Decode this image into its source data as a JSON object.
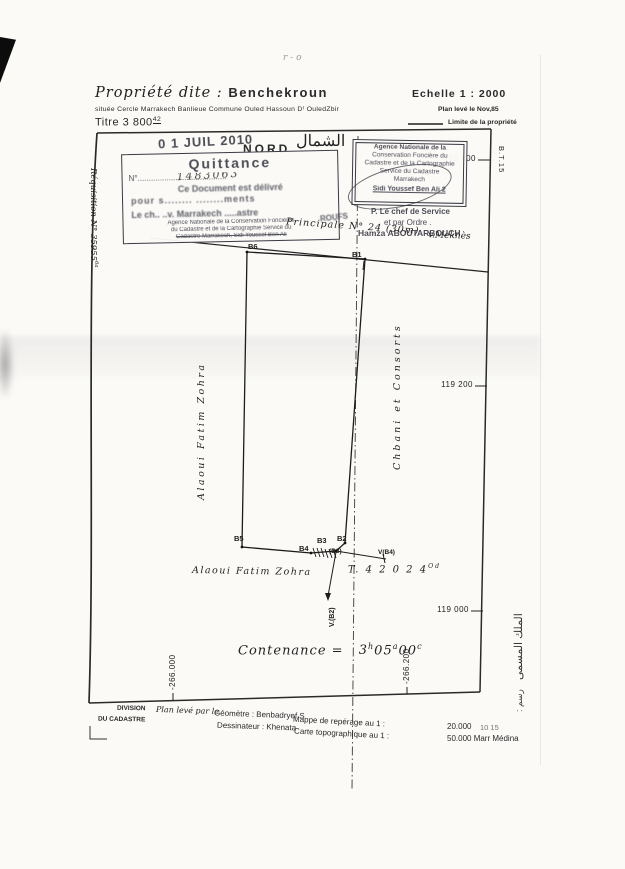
{
  "header": {
    "property_label": "Propriété dite :",
    "property_name": "Benchekroun",
    "scale": "Echelle  1 : 2000",
    "location": "située Cercle Marrakech Banlieue  Commune  Ouled  Hassoun  Dʳ OuledZbir",
    "plan_date": "Plan levé le  Nov,85",
    "title_number": "Titre  3 800",
    "title_sup": "42",
    "legend_limit": "Limite  de  la  propriété",
    "pencil_mark": "r - o"
  },
  "stamps": {
    "date_stamp": "0 1  JUIL  2010",
    "north": "NORD",
    "north_arabic": "الشمال",
    "quittance": {
      "title": "Quittance",
      "no_label": "N°",
      "no_dots": "........................................",
      "no_value": "1483063",
      "line_delivre": "Ce Document est délivré",
      "line_pour": "pour s........  ........ments",
      "line_chef": "Le ch..  ..v. Marrakech  .....astre",
      "agency_1": "Agence Nationale de la Conservation Foncières",
      "agency_2": "du Cadastre et de la Cartographie Service du",
      "agency_3": "Cadastre Marrakech, Sidi Youssef Ben Ali",
      "fragment": "ROUFS"
    },
    "service": {
      "line_1": "Agence Nationale de la",
      "line_2": "Conservation Foncière du",
      "line_3": "Cadastre et de la Cartographie",
      "line_4": "Service du Cadastre",
      "line_5": "Marrakech",
      "line_6": "Sidi Youssef Ben Ali   2"
    },
    "signature": {
      "line_1": "P. Le chef de Service",
      "line_2": "et par Ordre .",
      "line_3": "Hamza ABOUTARBOUCH"
    }
  },
  "plan": {
    "road_label": "Principale  N° 24 (30m)",
    "road_dest": "v.Meknès",
    "requisition": "Réquisition N° 35955",
    "requisition_sup": "6a",
    "owner_left": "Alaoui   Fatim   Zohra",
    "owner_right": "Chbani   et   Consorts",
    "owner_bottom": "Alaoui  Fatim  Zohra",
    "title_ref": "T. 4 2 0 2 4",
    "title_ref_sup": "Od",
    "contenance_label": "Contenance   =",
    "cont_h": "3",
    "cont_h_u": "h",
    "cont_a": "05",
    "cont_a_u": "a",
    "cont_c": "00",
    "cont_c_u": "c",
    "bt_ref": "B.T.15",
    "points": {
      "b6": "B6",
      "b1": "B1",
      "b5": "B5",
      "b4": "B4",
      "b3": "B3",
      "b2": "B2",
      "b3p": "(B3)",
      "vb4": "V(B4)",
      "vb2": "V.(B2)"
    }
  },
  "coords": {
    "right_1": "119 400",
    "right_2": "119 200",
    "right_3": "119 000",
    "bottom_1": "-266.000",
    "bottom_2": "-266.200"
  },
  "footer": {
    "division_1": "DIVISION",
    "division_2": "DU  CADASTRE",
    "leve_par": "Plan levé par le",
    "geometre": "Géomètre  : Benbadryef S",
    "dessinateur": "Dessinateur : Khenata",
    "mappe_label": "Mappe  de  repérage  au  1 :",
    "mappe_value": "20.000",
    "mappe_pencil": "10  15",
    "carte_label": "Carte  topographique  au  1 :",
    "carte_value": "50.000 Marr Médina"
  },
  "margin": {
    "arabic_property": "الملك المسمى",
    "arabic_note": ": رسم"
  }
}
